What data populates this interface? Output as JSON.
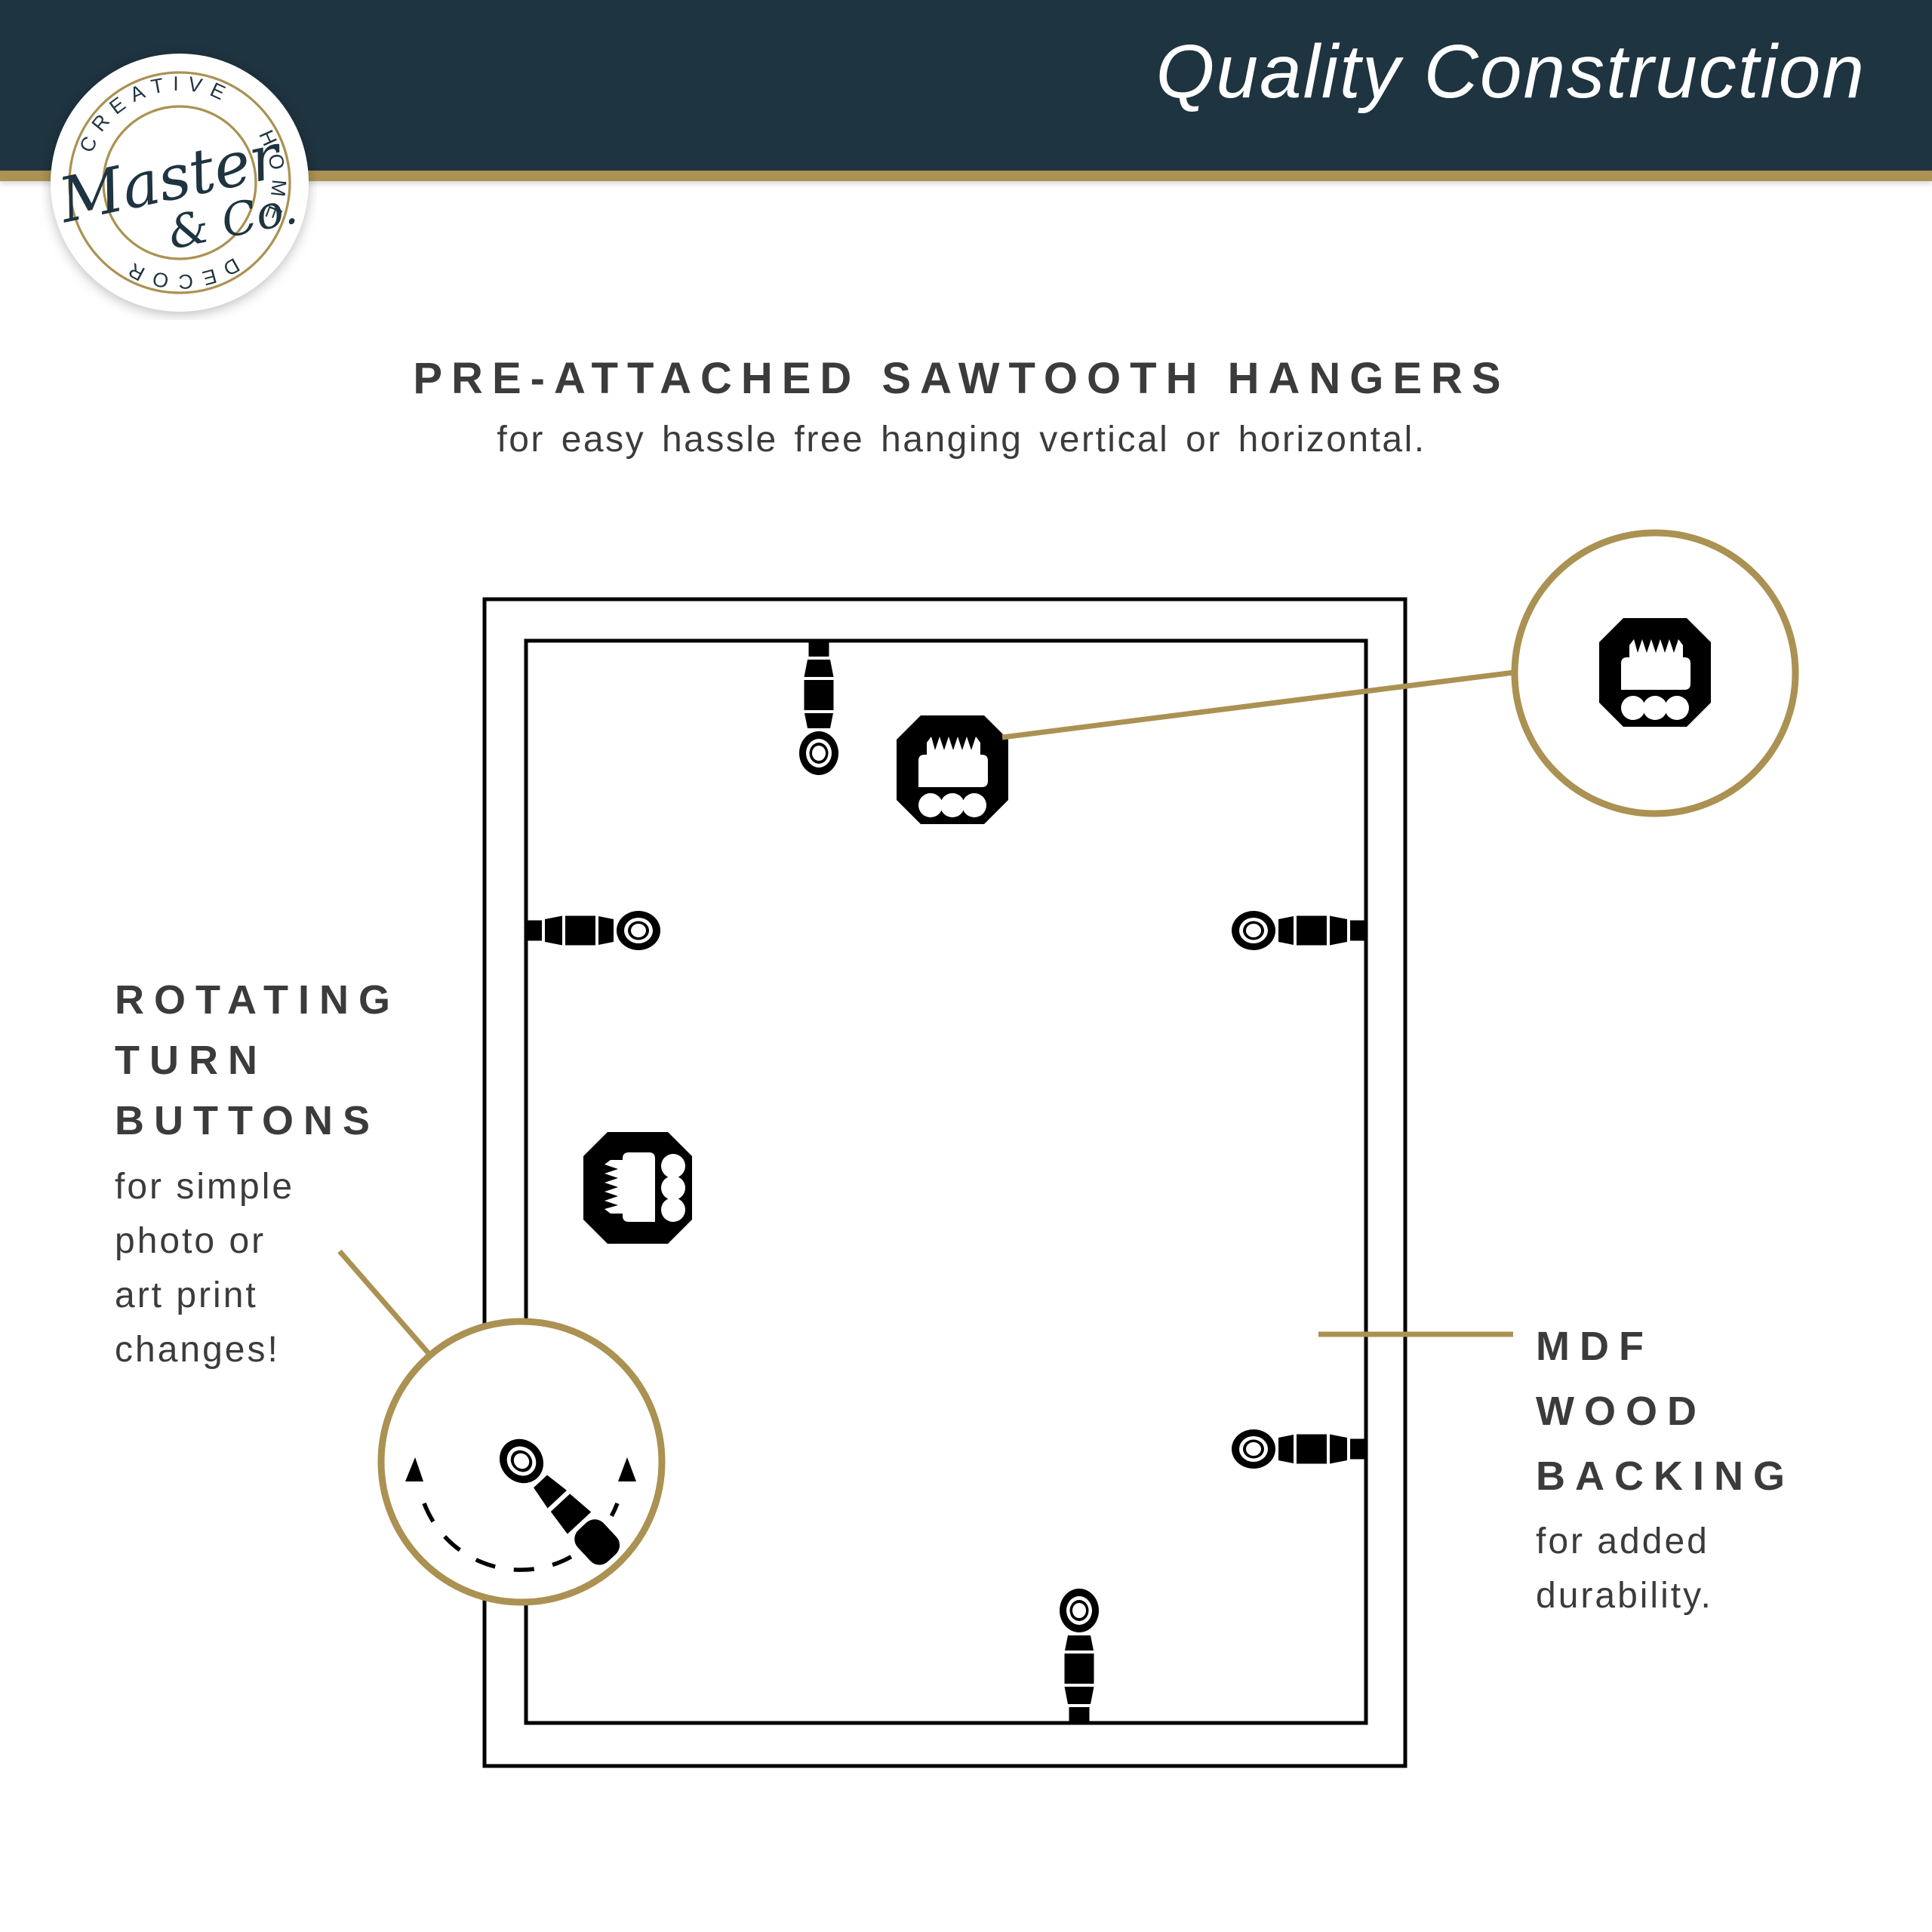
{
  "colors": {
    "navy": "#1E3440",
    "gold": "#AB9152",
    "text_gray": "#3B3B3B",
    "icon_black": "#000000",
    "background": "#FFFFFF"
  },
  "header": {
    "title": "Quality Construction"
  },
  "logo": {
    "ring_text": "CREATIVE HOME DECOR",
    "script_line1": "Master",
    "script_line2": "& Co."
  },
  "hero": {
    "title": "PRE-ATTACHED SAWTOOTH HANGERS",
    "subtitle": "for easy hassle free hanging vertical or horizontal."
  },
  "left_callout": {
    "title_lines": [
      "ROTATING",
      "TURN",
      "BUTTONS"
    ],
    "body_lines": [
      "for simple",
      "photo or",
      "art print",
      "changes!"
    ]
  },
  "right_callout": {
    "title_lines": [
      "MDF",
      "WOOD",
      "BACKING"
    ],
    "body_lines": [
      "for added",
      "durability."
    ]
  },
  "icons": {
    "sawtooth_hanger": "sawtooth-hanger-icon",
    "turn_button": "turn-button-icon",
    "rotation_arrows": "rotation-arrows-icon",
    "logo_badge": "brand-badge-icon"
  }
}
